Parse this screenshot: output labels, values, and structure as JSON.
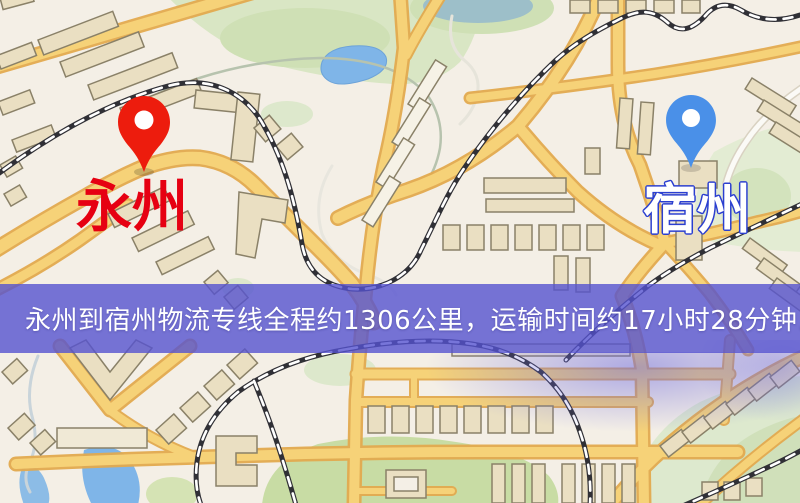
{
  "map": {
    "origin": {
      "label": "永州",
      "pin_color": "#ed1c0d",
      "label_color": "#e60012"
    },
    "destination": {
      "label": "宿州",
      "pin_color": "#4a90e8",
      "label_color": "#ffffff",
      "label_outline_color": "#2b3fd0"
    },
    "banner": {
      "text": "永州到宿州物流专线全程约1306公里，运输时间约17小时28分钟.",
      "background_color": "#5552d0",
      "text_color": "#ffffff"
    },
    "palette": {
      "land": "#f4efe6",
      "road_fill": "#f6d278",
      "road_casing": "#e3aa4f",
      "park": "#d9e6c4",
      "water": "#7fb5e8",
      "railway": "#303036",
      "building_fill": "#eadfc2",
      "building_outline": "#8a8168"
    }
  }
}
